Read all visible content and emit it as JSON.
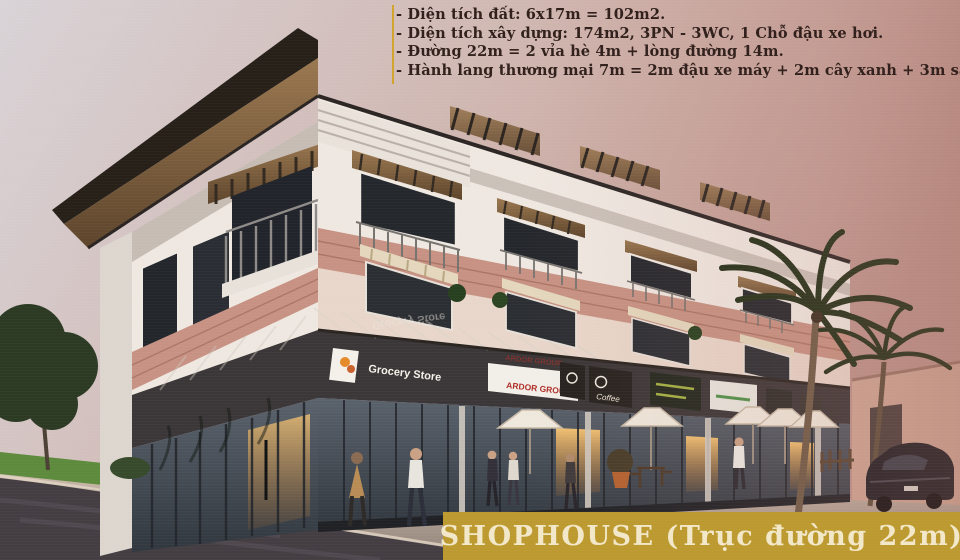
{
  "annotations": {
    "lines": [
      "- Diện tích đất: 6x17m = 102m2.",
      "- Diện tích xây dựng: 174m2, 3PN - 3WC, 1 Chỗ đậu xe hơi.",
      "- Đường 22m = 2 vỉa hè 4m + lòng đường 14m.",
      "- Hành lang thương mại 7m = 2m đậu xe máy + 2m cây xanh + 3m sân trước Shop."
    ],
    "text_color": "#301f1a",
    "rule_color": "#d2a42c"
  },
  "banner": {
    "title": "SHOPHOUSE (Trục đường 22m)",
    "bg": "#bd9a30",
    "fg": "#f2e8c9"
  },
  "signs": {
    "grocery": "Grocery Store",
    "ardor": "ARDOR GROUP",
    "coffee": "Coffee"
  },
  "palette": {
    "sky_left": "#d9d3d7",
    "sky_right": "#bd938b",
    "roof_dark": "#262019",
    "wall_light": "#efe8e1",
    "wall_warm": "#e9d6ca",
    "brick": "#c79283",
    "sign_band": "#3b3637",
    "road": "#443e43",
    "grass": "#5d8a3c",
    "foliage": "#2c3a24",
    "palm_green": "#223018",
    "umbrella": "#efe8dc",
    "car_body": "#1f1e24"
  }
}
